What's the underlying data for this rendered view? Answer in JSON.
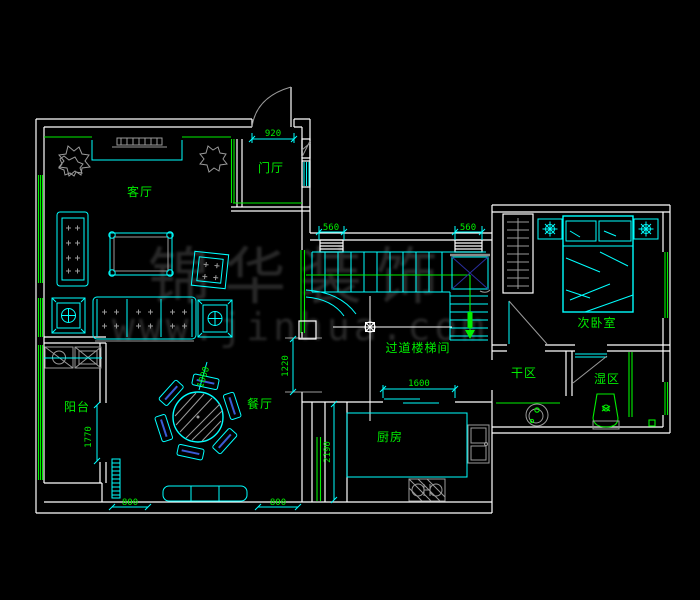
{
  "drawing": {
    "type": "cad-floor-plan",
    "background": "#000000",
    "colors": {
      "wall": "#ffffff",
      "furniture": "#00ffff",
      "label": "#00ef00",
      "door_swing": "#9a9a9a",
      "watermark": "#282828"
    }
  },
  "rooms": {
    "living": "客厅",
    "foyer": "门厅",
    "dining": "餐厅",
    "balcony": "阳台",
    "kitchen": "厨房",
    "stair_hall": "过道楼梯间",
    "bedroom": "次卧室",
    "dry_area": "干区",
    "wet_area": "湿区"
  },
  "dimensions": {
    "entry_door": "920",
    "shaft_left": "560",
    "shaft_right": "560",
    "kitchen_opening": "1600",
    "kitchen_depth": "2190",
    "dining_opening": "1220",
    "balcony_opening": "1770",
    "table": "1000",
    "window_left": "800",
    "window_right": "800"
  },
  "watermark": {
    "line1": "锦华装饰",
    "line2": "www.jinhua.com"
  }
}
